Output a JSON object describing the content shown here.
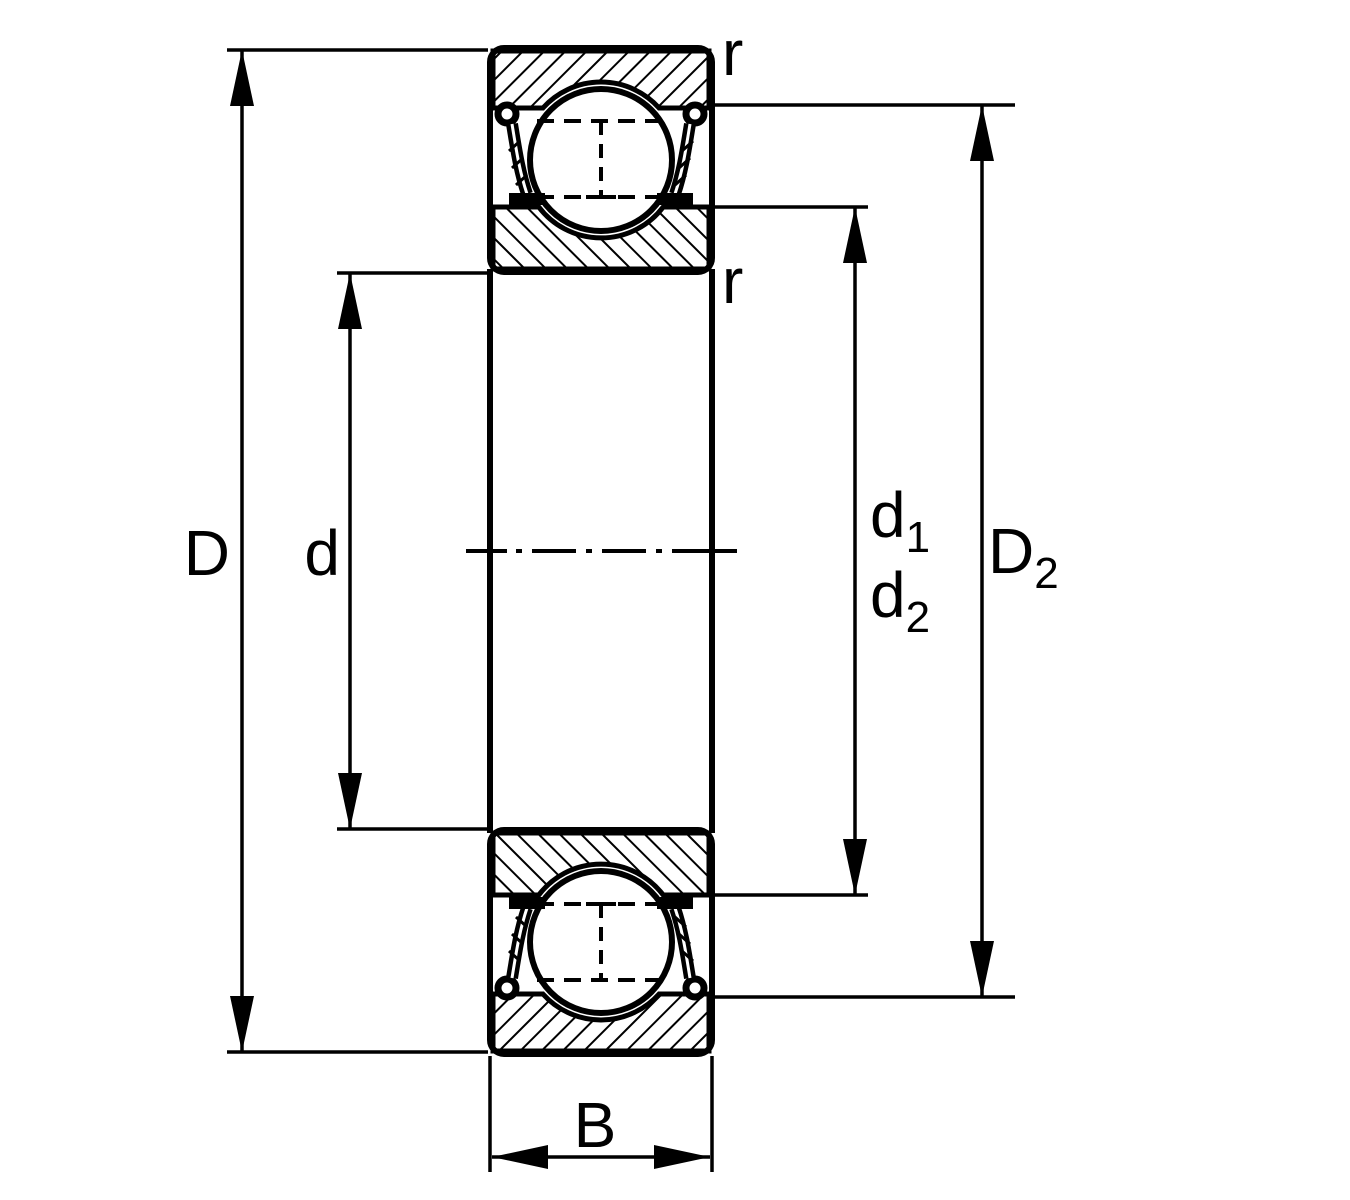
{
  "labels": {
    "outer_diameter": "D",
    "bore_diameter": "d",
    "recess_diameter_1": {
      "base": "d",
      "sub": "1"
    },
    "recess_diameter_2": {
      "base": "d",
      "sub": "2"
    },
    "shoulder_diameter": {
      "base": "D",
      "sub": "2"
    },
    "width": "B",
    "chamfer_outer": "r",
    "chamfer_inner": "r"
  },
  "colors": {
    "ink": "#000000",
    "paper": "#ffffff"
  }
}
